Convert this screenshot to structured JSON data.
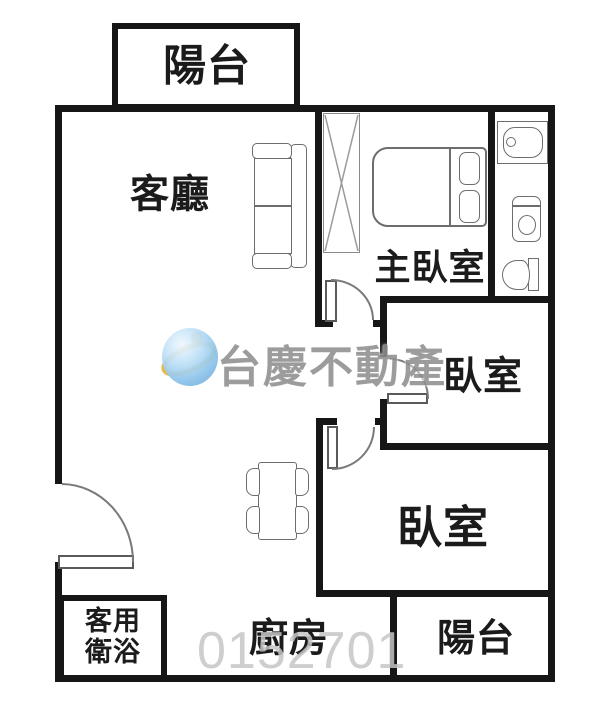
{
  "rooms": {
    "balcony_top": {
      "label": "陽台"
    },
    "living_room": {
      "label": "客廳"
    },
    "master_bedroom": {
      "label": "主臥室"
    },
    "bedroom_middle": {
      "label": "臥室"
    },
    "bedroom_large": {
      "label": "臥室"
    },
    "kitchen": {
      "label": "廚房"
    },
    "balcony_bottom": {
      "label": "陽台"
    },
    "guest_bathroom": {
      "label_line1": "客用",
      "label_line2": "衛浴"
    }
  },
  "watermark": {
    "brand_text": "台慶不動產",
    "listing_number": "0152701"
  },
  "colors": {
    "wall": "#161616",
    "furniture_stroke": "#6d6d6d",
    "label_text": "#1b1b1b",
    "watermark_text": "#8f8f8f",
    "watermark_number": "#c6c6c6",
    "logo_blue": "#8cc3ea",
    "logo_gold": "#e7b63f"
  },
  "fixtures": {
    "icon_names": [
      "wardrobe-icon",
      "double-bed-icon",
      "pillow-icon",
      "sofa-icon",
      "bathtub-icon",
      "washing-machine-icon",
      "toilet-icon",
      "dining-table-icon",
      "chair-icon",
      "door-swing-icon",
      "entrance-door-icon",
      "brand-logo-icon"
    ]
  }
}
